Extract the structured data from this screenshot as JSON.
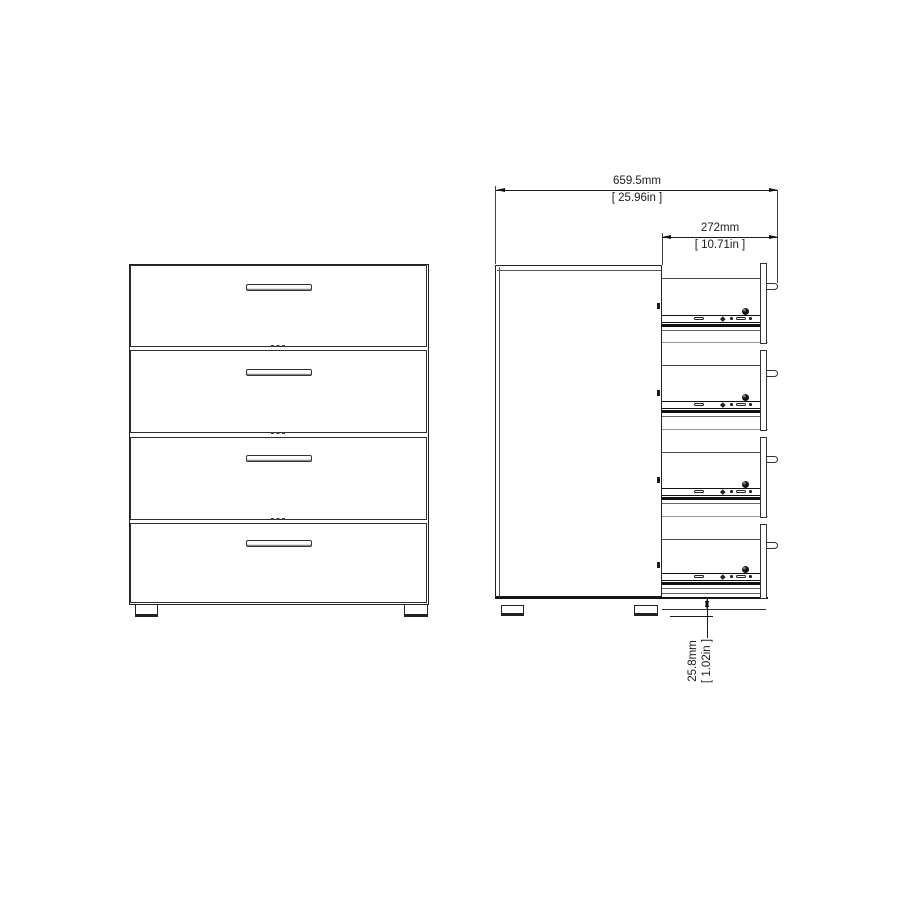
{
  "drawing": {
    "subject": "four-drawer-chest-technical-drawing",
    "colors": {
      "line": "#1b1b1b",
      "secondary_line": "#999999",
      "background": "#ffffff"
    }
  },
  "dims": {
    "width_mm": "659.5mm",
    "width_in": "[ 25.96in ]",
    "depth_mm": "272mm",
    "depth_in": "[ 10.71in ]",
    "clearance_mm": "25.8mm",
    "clearance_in": "[ 1.02in ]"
  }
}
